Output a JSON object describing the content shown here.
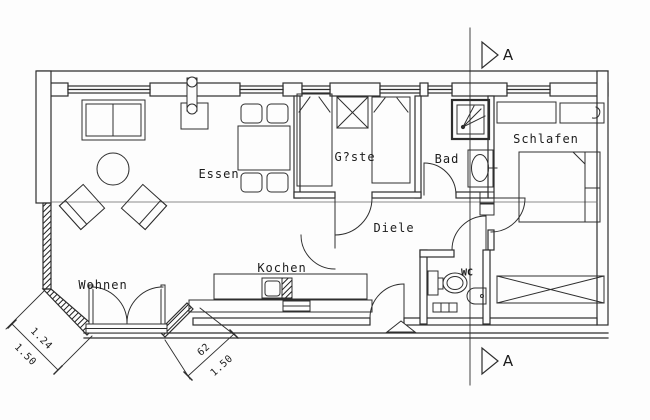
{
  "drawing": {
    "type": "floor-plan",
    "background": "#fdfdfd",
    "line_color": "#2e2e2e",
    "rooms": [
      {
        "id": "essen",
        "label": "Essen"
      },
      {
        "id": "gaeste",
        "label": "G?ste"
      },
      {
        "id": "bad",
        "label": "Bad"
      },
      {
        "id": "schlafen",
        "label": "Schlafen"
      },
      {
        "id": "diele",
        "label": "Diele"
      },
      {
        "id": "wohnen",
        "label": "Wohnen"
      },
      {
        "id": "kochen",
        "label": "Kochen"
      },
      {
        "id": "wc",
        "label": "WC"
      }
    ],
    "section_marker": {
      "top": "A",
      "bottom": "A"
    },
    "dimensions": {
      "corner": {
        "value1": "1.24",
        "value2": "1.50"
      },
      "step": {
        "value1": "62",
        "value2": "1.50"
      }
    }
  }
}
